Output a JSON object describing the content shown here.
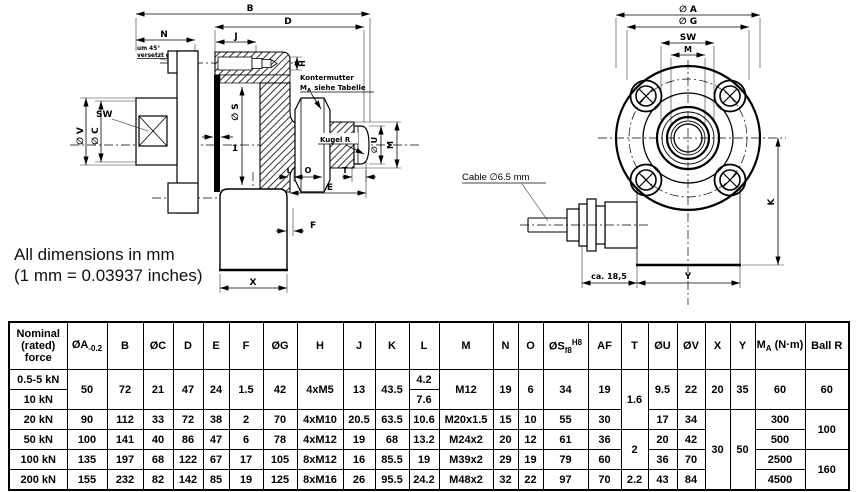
{
  "note": {
    "line1": "All dimensions in mm",
    "line2": "(1 mm = 0.03937 inches)"
  },
  "left_drawing": {
    "dims": {
      "B": "B",
      "D": "D",
      "N": "N",
      "J": "J",
      "H": "H",
      "S": "∅ S",
      "V": "∅ V",
      "C": "∅ C",
      "SW": "SW",
      "one": "1",
      "U": "∅ U",
      "M": "M",
      "T": "T",
      "L": "L",
      "O": "O",
      "E": "E",
      "F": "F",
      "X": "X"
    },
    "annotations": {
      "offset_l1": "um 45°",
      "offset_l2": "versetzt gez.",
      "locknut_l1": "Kontermutter",
      "locknut_m": "M",
      "locknut_sub": "A",
      "locknut_rest": "siehe Tabelle",
      "ball": "Kugel R"
    }
  },
  "right_drawing": {
    "dims": {
      "A": "∅ A",
      "G": "∅ G",
      "SW": "SW",
      "M": "M",
      "K": "K",
      "Y": "Y",
      "cable_len": "ca. 18,5"
    },
    "annotations": {
      "cable": "Cable ∅6.5 mm"
    }
  },
  "table": {
    "columns": [
      {
        "m": "Nominal (rated) force"
      },
      {
        "m": "ØA",
        "sub": "-0.2"
      },
      {
        "m": "B"
      },
      {
        "m": "ØC"
      },
      {
        "m": "D"
      },
      {
        "m": "E"
      },
      {
        "m": "F"
      },
      {
        "m": "ØG"
      },
      {
        "m": "H"
      },
      {
        "m": "J"
      },
      {
        "m": "K"
      },
      {
        "m": "L"
      },
      {
        "m": "M"
      },
      {
        "m": "N"
      },
      {
        "m": "O"
      },
      {
        "m": "ØS",
        "sub": "f8",
        "sup": "H8"
      },
      {
        "m": "AF"
      },
      {
        "m": "T"
      },
      {
        "m": "ØU"
      },
      {
        "m": "ØV"
      },
      {
        "m": "X"
      },
      {
        "m": "Y"
      },
      {
        "m": "M",
        "sub": "A",
        "post": " (N·m)"
      },
      {
        "m": "Ball R"
      }
    ],
    "rows": [
      {
        "cells": [
          {
            "t": "0.5-5 kN"
          },
          {
            "t": "50",
            "rs": 2
          },
          {
            "t": "72",
            "rs": 2
          },
          {
            "t": "21",
            "rs": 2
          },
          {
            "t": "47",
            "rs": 2
          },
          {
            "t": "24",
            "rs": 2
          },
          {
            "t": "1.5",
            "rs": 2
          },
          {
            "t": "42",
            "rs": 2
          },
          {
            "t": "4xM5",
            "rs": 2
          },
          {
            "t": "13",
            "rs": 2
          },
          {
            "t": "43.5",
            "rs": 2
          },
          {
            "t": "4.2"
          },
          {
            "t": "M12",
            "rs": 2
          },
          {
            "t": "19",
            "rs": 2
          },
          {
            "t": "6",
            "rs": 2
          },
          {
            "t": "34",
            "rs": 2
          },
          {
            "t": "19",
            "rs": 2
          },
          {
            "t": "1.6",
            "rs": 3
          },
          {
            "t": "9.5",
            "rs": 2
          },
          {
            "t": "22",
            "rs": 2
          },
          {
            "t": "20",
            "rs": 2
          },
          {
            "t": "35",
            "rs": 2
          },
          {
            "t": "60",
            "rs": 2
          },
          {
            "t": "60",
            "rs": 2
          }
        ]
      },
      {
        "cells": [
          {
            "t": "10 kN"
          },
          {
            "t": "7.6"
          }
        ]
      },
      {
        "cells": [
          {
            "t": "20 kN"
          },
          {
            "t": "90"
          },
          {
            "t": "112"
          },
          {
            "t": "33"
          },
          {
            "t": "72"
          },
          {
            "t": "38"
          },
          {
            "t": "2"
          },
          {
            "t": "70"
          },
          {
            "t": "4xM10"
          },
          {
            "t": "20.5"
          },
          {
            "t": "63.5"
          },
          {
            "t": "10.6"
          },
          {
            "t": "M20x1.5"
          },
          {
            "t": "15"
          },
          {
            "t": "10"
          },
          {
            "t": "55"
          },
          {
            "t": "30"
          },
          {
            "t": "17"
          },
          {
            "t": "34"
          },
          {
            "t": "30",
            "rs": 4
          },
          {
            "t": "50",
            "rs": 4
          },
          {
            "t": "300"
          },
          {
            "t": "100",
            "rs": 2
          }
        ]
      },
      {
        "cells": [
          {
            "t": "50 kN"
          },
          {
            "t": "100"
          },
          {
            "t": "141"
          },
          {
            "t": "40"
          },
          {
            "t": "86"
          },
          {
            "t": "47"
          },
          {
            "t": "6"
          },
          {
            "t": "78"
          },
          {
            "t": "4xM12"
          },
          {
            "t": "19"
          },
          {
            "t": "68"
          },
          {
            "t": "13.2"
          },
          {
            "t": "M24x2"
          },
          {
            "t": "20"
          },
          {
            "t": "12"
          },
          {
            "t": "61"
          },
          {
            "t": "36"
          },
          {
            "t": "2",
            "rs": 2
          },
          {
            "t": "20"
          },
          {
            "t": "42"
          },
          {
            "t": "500"
          }
        ]
      },
      {
        "cells": [
          {
            "t": "100 kN"
          },
          {
            "t": "135"
          },
          {
            "t": "197"
          },
          {
            "t": "68"
          },
          {
            "t": "122"
          },
          {
            "t": "67"
          },
          {
            "t": "17"
          },
          {
            "t": "105"
          },
          {
            "t": "8xM12"
          },
          {
            "t": "16"
          },
          {
            "t": "85.5"
          },
          {
            "t": "19"
          },
          {
            "t": "M39x2"
          },
          {
            "t": "29"
          },
          {
            "t": "19"
          },
          {
            "t": "79"
          },
          {
            "t": "60"
          },
          {
            "t": "36"
          },
          {
            "t": "70"
          },
          {
            "t": "2500"
          },
          {
            "t": "160",
            "rs": 2
          }
        ]
      },
      {
        "cells": [
          {
            "t": "200 kN"
          },
          {
            "t": "155"
          },
          {
            "t": "232"
          },
          {
            "t": "82"
          },
          {
            "t": "142"
          },
          {
            "t": "85"
          },
          {
            "t": "19"
          },
          {
            "t": "125"
          },
          {
            "t": "8xM16"
          },
          {
            "t": "26"
          },
          {
            "t": "95.5"
          },
          {
            "t": "24.2"
          },
          {
            "t": "M48x2"
          },
          {
            "t": "32"
          },
          {
            "t": "22"
          },
          {
            "t": "97"
          },
          {
            "t": "70"
          },
          {
            "t": "2.2"
          },
          {
            "t": "43"
          },
          {
            "t": "84"
          },
          {
            "t": "4500"
          }
        ]
      }
    ]
  }
}
